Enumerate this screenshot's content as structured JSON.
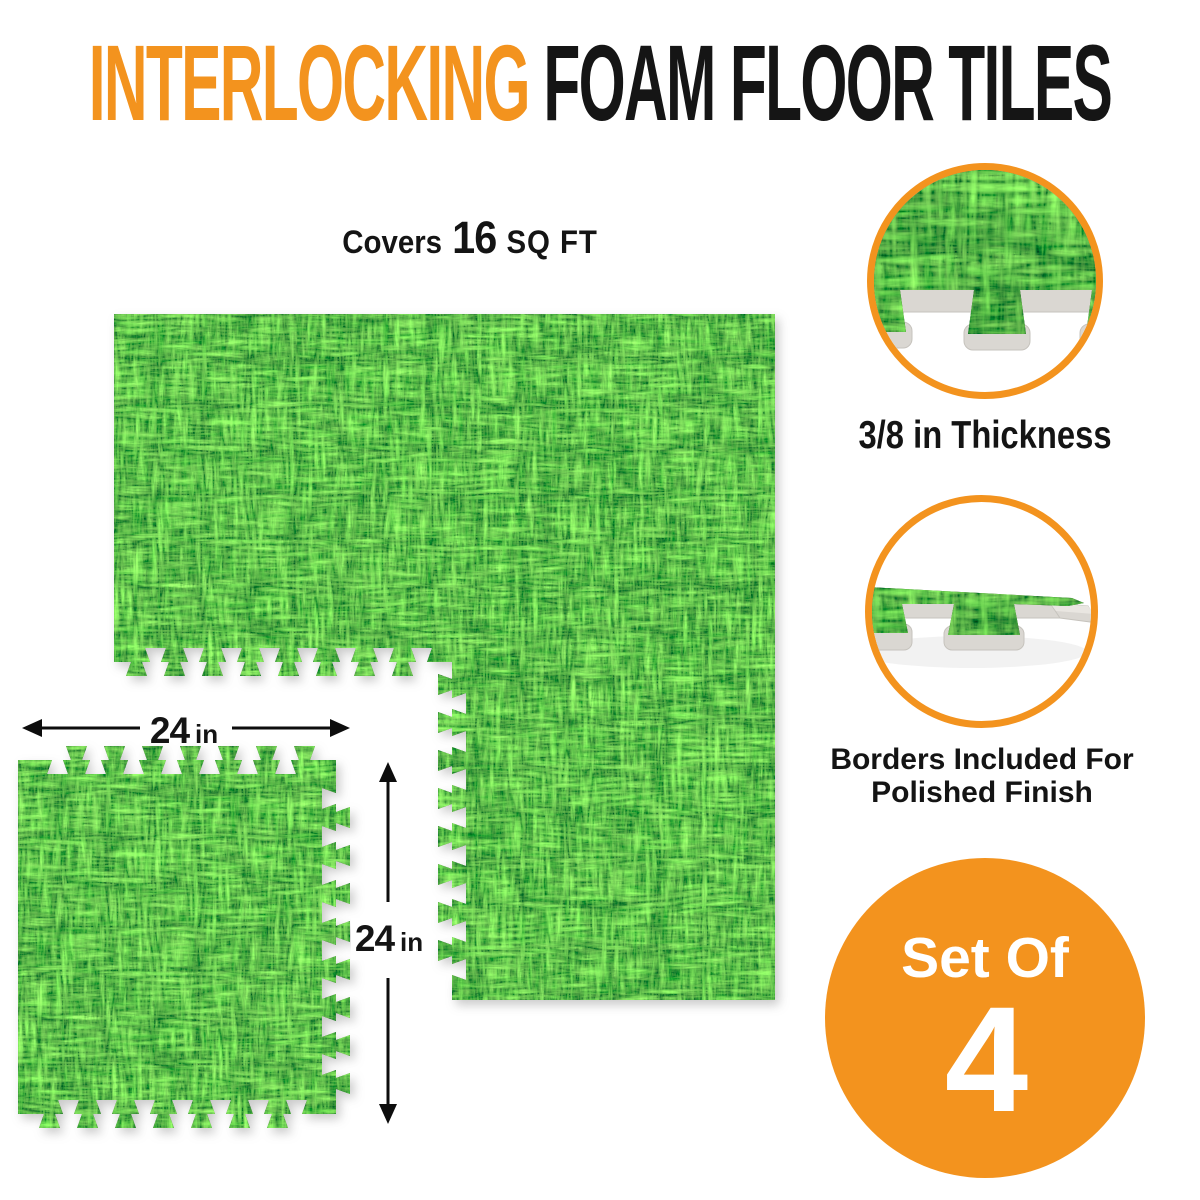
{
  "title": {
    "highlight": "INTERLOCKING",
    "rest": "FOAM FLOOR TILES"
  },
  "coverage": {
    "prefix": "Covers",
    "value": "16",
    "unit": "SQ FT"
  },
  "dimension_labels": {
    "width": {
      "value": "24",
      "unit": "in"
    },
    "height": {
      "value": "24",
      "unit": "in"
    }
  },
  "callouts": {
    "thickness": {
      "caption": "3/8 in Thickness"
    },
    "borders": {
      "caption_line1": "Borders Included For",
      "caption_line2": "Polished Finish"
    }
  },
  "badge": {
    "line1": "Set Of",
    "line2": "4"
  },
  "colors": {
    "accent_orange": "#F3931E",
    "text_black": "#141414",
    "grass_bright": "#7CD93F",
    "grass_mid": "#46A31A",
    "grass_dark": "#1C3A0A",
    "foam_gray": "#DAD7D2"
  }
}
